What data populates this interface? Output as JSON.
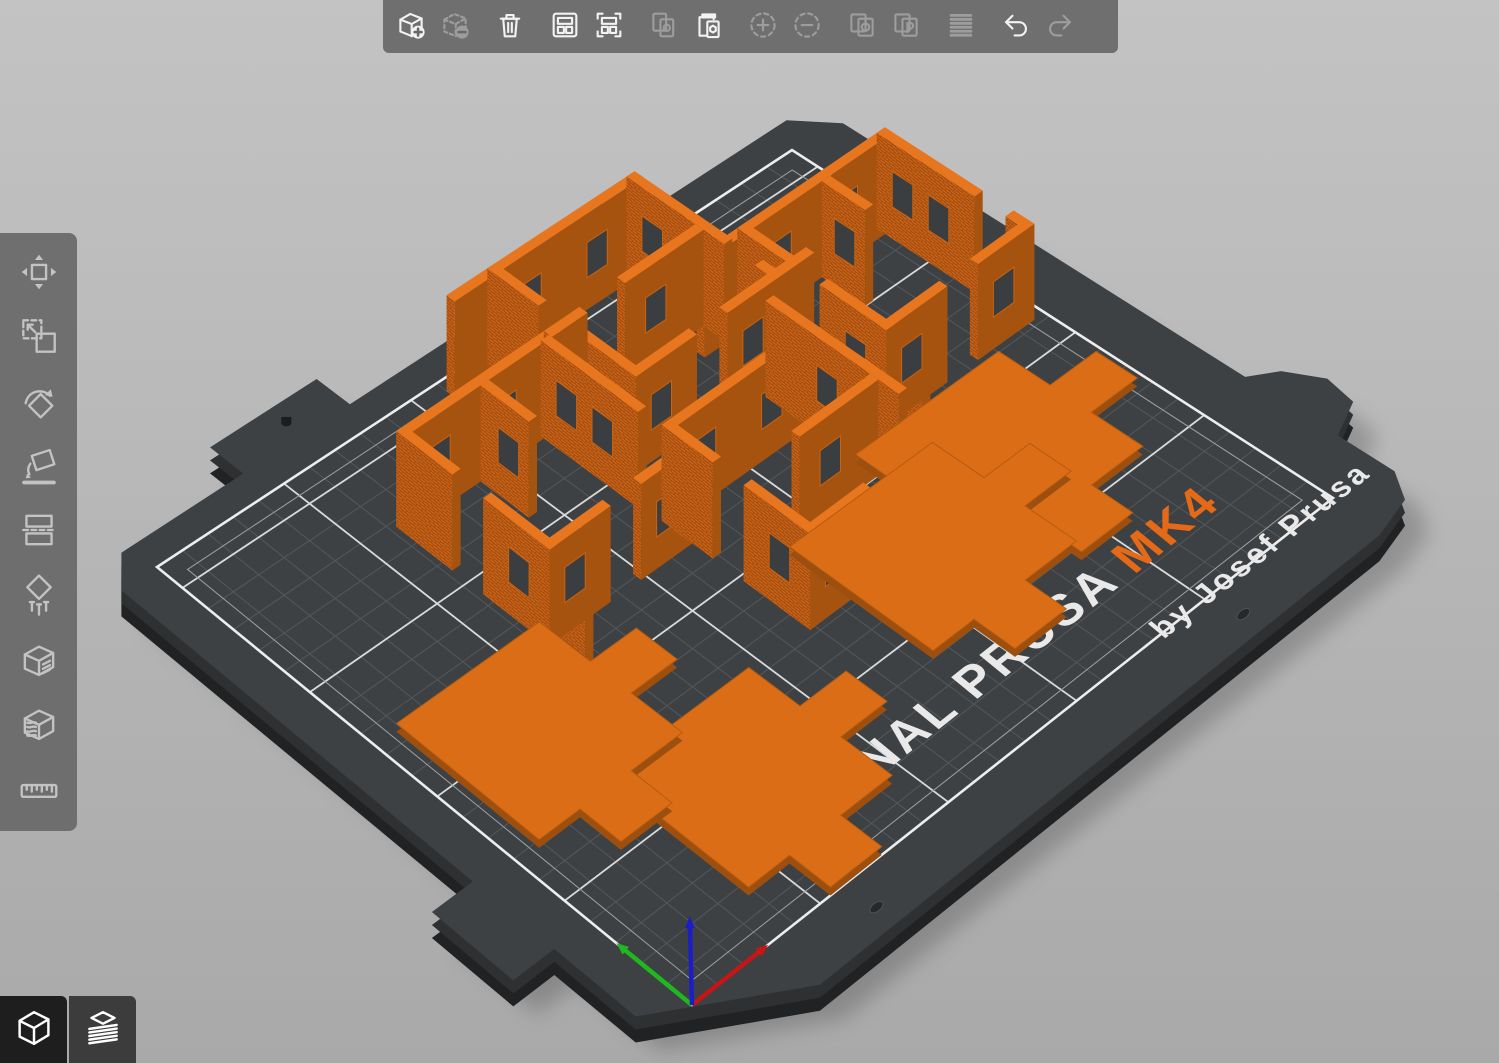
{
  "toolbar": {
    "groups": [
      [
        {
          "id": "add-object",
          "label": "Add",
          "enabled": true
        },
        {
          "id": "delete-object",
          "label": "Delete",
          "enabled": false
        }
      ],
      [
        {
          "id": "delete-all",
          "label": "Delete all",
          "enabled": true
        }
      ],
      [
        {
          "id": "arrange",
          "label": "Arrange",
          "enabled": true
        },
        {
          "id": "arrange-selection",
          "label": "Arrange selection",
          "enabled": true
        }
      ],
      [
        {
          "id": "copy",
          "label": "Copy",
          "enabled": false
        },
        {
          "id": "paste",
          "label": "Paste",
          "enabled": true
        }
      ],
      [
        {
          "id": "add-instance",
          "label": "Add instance",
          "enabled": false
        },
        {
          "id": "remove-instance",
          "label": "Remove instance",
          "enabled": false
        }
      ],
      [
        {
          "id": "split-objects",
          "label": "Split to objects",
          "enabled": false
        },
        {
          "id": "split-parts",
          "label": "Split to parts",
          "enabled": false
        }
      ],
      [
        {
          "id": "variable-layer-height",
          "label": "Variable layer height",
          "enabled": false
        }
      ],
      [
        {
          "id": "undo",
          "label": "Undo",
          "enabled": true
        },
        {
          "id": "redo",
          "label": "Redo",
          "enabled": false
        }
      ]
    ]
  },
  "gizmo_sidebar": {
    "items": [
      {
        "id": "move",
        "label": "Move"
      },
      {
        "id": "scale",
        "label": "Scale"
      },
      {
        "id": "rotate",
        "label": "Rotate"
      },
      {
        "id": "place-on-face",
        "label": "Place on face"
      },
      {
        "id": "cut",
        "label": "Cut"
      },
      {
        "id": "fdm-supports",
        "label": "Paint-on supports"
      },
      {
        "id": "seam",
        "label": "Seam painting"
      },
      {
        "id": "mmu-painting",
        "label": "Multimaterial painting"
      },
      {
        "id": "measure",
        "label": "Measure"
      }
    ]
  },
  "view_buttons": [
    {
      "id": "editor-3d",
      "label": "3D editor view",
      "active": true
    },
    {
      "id": "preview-layers",
      "label": "Sliced preview",
      "active": false
    }
  ],
  "bed": {
    "label": "ORIGINAL PRUSA",
    "label_accent": "MK4",
    "byline": "by Josef Prusa",
    "colors": {
      "sheet": "#3E4143",
      "sheet_mid": "#2E3032",
      "sheet_deep": "#202223",
      "grid_minor": "#55585A",
      "grid_major": "#D8DADB",
      "border": "#EDEDED",
      "accent": "#E56A17",
      "label_white": "#E9E9E9"
    }
  },
  "scene": {
    "projection": {
      "a": [
        692,
        1005
      ],
      "b": [
        1333,
        498
      ],
      "c": [
        792,
        150
      ],
      "d": [
        157,
        567
      ],
      "kz": 3.2
    },
    "model_colors": {
      "top": "#E8761F",
      "brick": "#C96418",
      "dark": "#A5530F",
      "tile_top": "#DC6D17",
      "tile_side": "#9C4F0E",
      "window_fill": "#3B3E40",
      "window_edge": "#C96311"
    },
    "wall": {
      "height": 30,
      "thickness": 3.2
    },
    "modules": [
      {
        "name": "wall-module-right",
        "walls": [
          {
            "t": "u",
            "a": 188,
            "b": 246,
            "p": 166.8,
            "w": [
              202,
              228
            ]
          },
          {
            "t": "u",
            "a": 172,
            "b": 188,
            "p": 166.8,
            "w": []
          },
          {
            "t": "v",
            "u": 242.8,
            "a": 112,
            "b": 120,
            "w": []
          },
          {
            "t": "v",
            "u": 242.8,
            "a": 132,
            "b": 170,
            "w": [
              146,
              160
            ]
          },
          {
            "t": "v",
            "u": 218,
            "a": 150,
            "b": 166.8,
            "w": [
              158
            ]
          },
          {
            "t": "v",
            "u": 188,
            "a": 112,
            "b": 138,
            "w": [
              124
            ]
          },
          {
            "t": "v",
            "u": 188,
            "a": 150,
            "b": 170,
            "w": []
          },
          {
            "t": "v",
            "u": 188,
            "a": 98,
            "b": 112,
            "w": []
          },
          {
            "t": "u",
            "a": 188,
            "b": 212,
            "p": 112,
            "w": [
              198
            ]
          },
          {
            "t": "u",
            "a": 224,
            "b": 246,
            "p": 112,
            "w": [
              234
            ]
          }
        ]
      },
      {
        "name": "wall-module-back",
        "walls": [
          {
            "t": "u",
            "a": 126,
            "b": 184,
            "p": 202.8,
            "w": [
              140,
              166
            ]
          },
          {
            "t": "u",
            "a": 110,
            "b": 126,
            "p": 202.8,
            "w": []
          },
          {
            "t": "v",
            "u": 180.8,
            "a": 148,
            "b": 156,
            "w": []
          },
          {
            "t": "v",
            "u": 180.8,
            "a": 168,
            "b": 206,
            "w": [
              182,
              196
            ]
          },
          {
            "t": "u",
            "a": 150,
            "b": 180.8,
            "p": 176,
            "w": [
              162
            ]
          },
          {
            "t": "v",
            "u": 126,
            "a": 148,
            "b": 174,
            "w": [
              160
            ]
          },
          {
            "t": "v",
            "u": 126,
            "a": 186,
            "b": 206,
            "w": []
          },
          {
            "t": "u",
            "a": 126,
            "b": 150,
            "p": 148,
            "w": [
              136
            ]
          },
          {
            "t": "u",
            "a": 162,
            "b": 196,
            "p": 148,
            "w": [
              172
            ]
          }
        ]
      },
      {
        "name": "wall-module-left",
        "walls": [
          {
            "t": "u",
            "a": 62,
            "b": 120,
            "p": 174.8,
            "w": [
              76,
              102
            ]
          },
          {
            "t": "u",
            "a": 120,
            "b": 134,
            "p": 174.8,
            "w": []
          },
          {
            "t": "v",
            "u": 116.8,
            "a": 118,
            "b": 126,
            "w": []
          },
          {
            "t": "v",
            "u": 116.8,
            "a": 138,
            "b": 176,
            "w": [
              152,
              166
            ]
          },
          {
            "t": "v",
            "u": 92,
            "a": 156,
            "b": 174.8,
            "w": [
              164
            ]
          },
          {
            "t": "v",
            "u": 62,
            "a": 118,
            "b": 144,
            "w": [
              130
            ]
          },
          {
            "t": "v",
            "u": 62,
            "a": 156,
            "b": 176,
            "w": []
          },
          {
            "t": "v",
            "u": 62,
            "a": 104,
            "b": 118,
            "w": []
          },
          {
            "t": "u",
            "a": 62,
            "b": 86,
            "p": 118,
            "w": [
              72
            ]
          },
          {
            "t": "u",
            "a": 98,
            "b": 120,
            "p": 118,
            "w": [
              108
            ]
          }
        ]
      },
      {
        "name": "wall-module-front",
        "walls": [
          {
            "t": "u",
            "a": 118,
            "b": 176,
            "p": 126.8,
            "w": [
              132,
              158
            ]
          },
          {
            "t": "v",
            "u": 172.8,
            "a": 130,
            "b": 144,
            "w": []
          },
          {
            "t": "v",
            "u": 172.8,
            "a": 72,
            "b": 80,
            "w": []
          },
          {
            "t": "v",
            "u": 172.8,
            "a": 92,
            "b": 130,
            "w": [
              106,
              120
            ]
          },
          {
            "t": "u",
            "a": 142,
            "b": 172.8,
            "p": 100,
            "w": [
              154
            ]
          },
          {
            "t": "v",
            "u": 118,
            "a": 72,
            "b": 98,
            "w": [
              84
            ]
          },
          {
            "t": "v",
            "u": 118,
            "a": 110,
            "b": 130,
            "w": []
          },
          {
            "t": "u",
            "a": 118,
            "b": 142,
            "p": 72,
            "w": [
              128
            ]
          },
          {
            "t": "u",
            "a": 154,
            "b": 176,
            "p": 72,
            "w": [
              164
            ]
          }
        ]
      }
    ],
    "tile_poly": [
      [
        0,
        0
      ],
      [
        16,
        0
      ],
      [
        16,
        -16
      ],
      [
        36,
        -16
      ],
      [
        36,
        0
      ],
      [
        56,
        0
      ],
      [
        56,
        20
      ],
      [
        74,
        20
      ],
      [
        74,
        36
      ],
      [
        56,
        36
      ],
      [
        56,
        56
      ],
      [
        0,
        56
      ]
    ],
    "tiles": [
      {
        "name": "tile-right",
        "origin": [
          172,
          52
        ]
      },
      {
        "name": "tile-mid-right",
        "origin": [
          134,
          40
        ]
      },
      {
        "name": "tile-mid",
        "origin": [
          38,
          16
        ]
      },
      {
        "name": "tile-left",
        "origin": [
          8,
          68
        ]
      }
    ],
    "axes": {
      "x_len": 26,
      "y_len": 26,
      "z_len": 24,
      "x_color": "#C81414",
      "y_color": "#1FB81F",
      "z_color": "#1D1DC8"
    },
    "label_pos": {
      "u": 44,
      "v": 20,
      "size": 15
    },
    "byline_pos": {
      "u": 182,
      "v": -2,
      "size": 9.5
    }
  }
}
